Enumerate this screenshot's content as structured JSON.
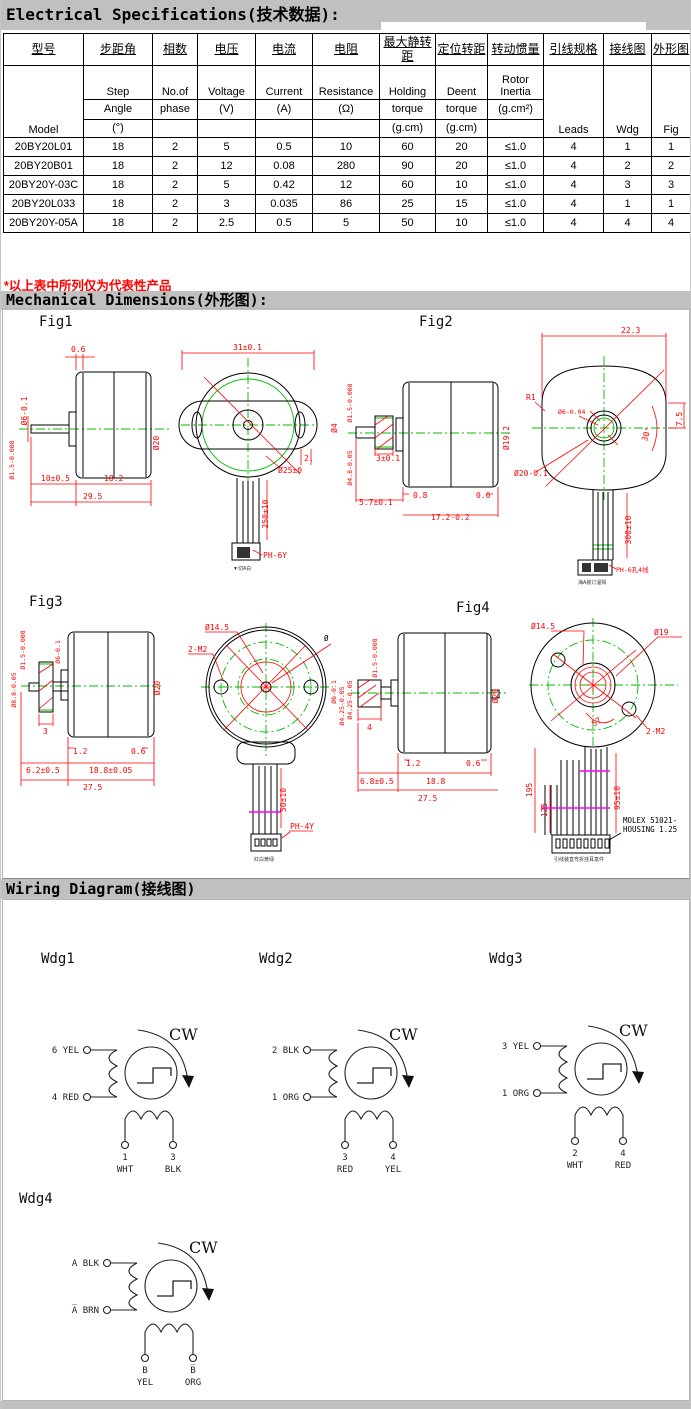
{
  "titles": {
    "electrical": "Electrical Specifications(技术数据):",
    "note": "*以上表中所列仅为代表性产品",
    "mechanical": "Mechanical Dimensions(外形图):",
    "wiring": "Wiring Diagram(接线图)"
  },
  "colors": {
    "bar_gray": "#c0c0c0",
    "note_red": "#ff0000",
    "cad_red": "#ff0000",
    "cad_green": "#00bb00",
    "tie_magenta": "#ff00ff"
  },
  "table": {
    "col1": {
      "cn": "型号",
      "en": "Model"
    },
    "cols": [
      {
        "cn": "步距角",
        "r2": "Step",
        "r3": "Angle",
        "r4": "(°)"
      },
      {
        "cn": "相数",
        "r2": "No.of",
        "r3": "phase",
        "r4": ""
      },
      {
        "cn": "电压",
        "r2": "Voltage",
        "r3": "(V)",
        "r4": ""
      },
      {
        "cn": "电流",
        "r2": "Current",
        "r3": "(A)",
        "r4": ""
      },
      {
        "cn": "电阻",
        "r2": "Resistance",
        "r3": "(Ω)",
        "r4": ""
      },
      {
        "cn": "最大静转距",
        "r2": "Holding",
        "r3": "torque",
        "r4": "(g.cm)"
      },
      {
        "cn": "定位转距",
        "r2": "Deent",
        "r3": "torque",
        "r4": "(g.cm)"
      },
      {
        "cn": "转动惯量",
        "r2": "Rotor Inertia",
        "r3": "(g.cm²)",
        "r4": ""
      },
      {
        "cn": "引线规格",
        "en": "Leads"
      },
      {
        "cn": "接线图",
        "en": "Wdg"
      },
      {
        "cn": "外形图",
        "en": "Fig"
      }
    ],
    "rows": [
      [
        "20BY20L01",
        "18",
        "2",
        "5",
        "0.5",
        "10",
        "60",
        "20",
        "≤1.0",
        "4",
        "1",
        "1"
      ],
      [
        "20BY20B01",
        "18",
        "2",
        "12",
        "0.08",
        "280",
        "90",
        "20",
        "≤1.0",
        "4",
        "2",
        "2"
      ],
      [
        "20BY20Y-03C",
        "18",
        "2",
        "5",
        "0.42",
        "12",
        "60",
        "10",
        "≤1.0",
        "4",
        "3",
        "3"
      ],
      [
        "20BY20L033",
        "18",
        "2",
        "3",
        "0.035",
        "86",
        "25",
        "15",
        "≤1.0",
        "4",
        "1",
        "1"
      ],
      [
        "20BY20Y-05A",
        "18",
        "2",
        "2.5",
        "0.5",
        "5",
        "50",
        "10",
        "≤1.0",
        "4",
        "4",
        "4"
      ]
    ]
  },
  "figs": {
    "fig1": {
      "label": "Fig1",
      "d06": "0.6",
      "dia6": "Ø6-0.1",
      "dia15": "Ø1.5-0.008",
      "d10": "10±0.5",
      "d182": "18.2",
      "d295": "29.5",
      "dia20": "Ø20",
      "d31": "31±0.1",
      "dia25": "Ø25±0",
      "d2": "2.",
      "d250": "250±10",
      "conn": "PH-6Y",
      "note": "▼切A白",
      "dia4": "Ø4"
    },
    "fig2": {
      "label": "Fig2",
      "d223": "22.3",
      "r1": "R1",
      "dia6": "Ø6-0.04",
      "dia192": "Ø19.2",
      "a30": "30°",
      "d75": "7.5",
      "dia20": "Ø20-0.1",
      "d08": "0.8",
      "d06": "0.6",
      "d57": "5.7±0.1",
      "d172": "17.2-0.2",
      "d3": "3±0.1",
      "d300": "300±10",
      "dia15": "Ø1.5-0.008",
      "dia48": "Ø4.8-0.05",
      "conn": "PH-6孔4线",
      "note": "海A装订温褐"
    },
    "fig3": {
      "label": "Fig3",
      "dia15": "Ø1.5-0.008",
      "dia6": "Ø6-0.1",
      "dia88": "Ø8.8-0.05",
      "d3": "3",
      "d12": "1.2",
      "d06": "0.6",
      "d62": "6.2±0.5",
      "d188": "18.8±0.05",
      "d275": "27.5",
      "dia20": "Ø20",
      "dia145": "Ø14.5",
      "m2": "2-M2",
      "dia": "Ø",
      "dia6r": "Ø6-0.1",
      "dia425": "Ø4.25-0.05",
      "d50": "50±10",
      "conn": "PH-4Y",
      "note": "红白黄绿"
    },
    "fig4": {
      "label": "Fig4",
      "dia15": "Ø1.5-0.008",
      "d4": "4",
      "dia425": "Ø4.25-0.05",
      "d12": "1.2",
      "d06": "0.6",
      "d68": "6.8±0.5",
      "d188": "18.8",
      "d275": "27.5",
      "dia20": "Ø20",
      "dia145": "Ø14.5",
      "dia19": "Ø19",
      "a57": "57",
      "m2": "2-M2",
      "d195": "195",
      "d125": "125",
      "d95": "95±10",
      "molex1": "MOLEX 51021-",
      "molex2": "HOUSING 1.25",
      "note": "引线装直弯折挂耳富件"
    }
  },
  "wiring": {
    "wdg1": {
      "label": "Wdg1",
      "cw": "CW",
      "t1": "6 YEL",
      "t2": "4 RED",
      "b1n": "1",
      "b1c": "WHT",
      "b2n": "3",
      "b2c": "BLK"
    },
    "wdg2": {
      "label": "Wdg2",
      "cw": "CW",
      "t1": "2 BLK",
      "t2": "1 ORG",
      "b1n": "3",
      "b1c": "RED",
      "b2n": "4",
      "b2c": "YEL"
    },
    "wdg3": {
      "label": "Wdg3",
      "cw": "CW",
      "t1": "3 YEL",
      "t2": "1 ORG",
      "b1n": "2",
      "b1c": "WHT",
      "b2n": "4",
      "b2c": "RED"
    },
    "wdg4": {
      "label": "Wdg4",
      "cw": "CW",
      "t1": "A BLK",
      "t2": "A̅ BRN",
      "b1n": "B",
      "b1c": "YEL",
      "b2n": "B̅",
      "b2c": "ORG"
    }
  }
}
